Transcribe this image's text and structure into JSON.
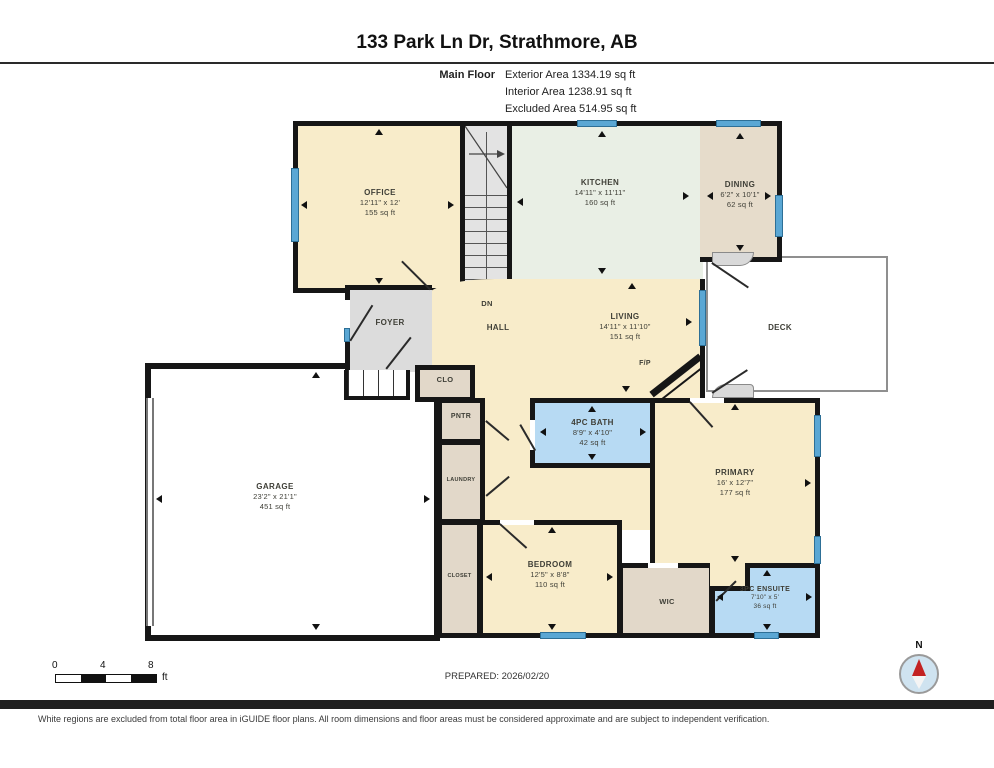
{
  "header": {
    "title": "133 Park Ln Dr, Strathmore, AB",
    "floor_label": "Main Floor",
    "area_lines": [
      "Exterior Area 1334.19 sq ft",
      "Interior Area 1238.91 sq ft",
      "Excluded Area 514.95 sq ft"
    ]
  },
  "rooms": {
    "office": {
      "name": "OFFICE",
      "dims": "12'11\" x 12'",
      "area": "155 sq ft"
    },
    "kitchen": {
      "name": "KITCHEN",
      "dims": "14'11\" x 11'11\"",
      "area": "160 sq ft"
    },
    "dining": {
      "name": "DINING",
      "dims": "6'2\" x 10'1\"",
      "area": "62 sq ft"
    },
    "living": {
      "name": "LIVING",
      "dims": "14'11\" x 11'10\"",
      "area": "151 sq ft"
    },
    "garage": {
      "name": "GARAGE",
      "dims": "23'2\" x 21'1\"",
      "area": "451 sq ft"
    },
    "bath": {
      "name": "4PC BATH",
      "dims": "8'9\" x 4'10\"",
      "area": "42 sq ft"
    },
    "primary": {
      "name": "PRIMARY",
      "dims": "16' x 12'7\"",
      "area": "177 sq ft"
    },
    "bedroom": {
      "name": "BEDROOM",
      "dims": "12'5\" x 8'8\"",
      "area": "110 sq ft"
    },
    "ensuite": {
      "name": "3PC ENSUITE",
      "dims": "7'10\" x 5'",
      "area": "36 sq ft"
    },
    "foyer": {
      "name": "FOYER"
    },
    "hall": {
      "name": "HALL"
    },
    "dn": {
      "name": "DN"
    },
    "deck": {
      "name": "DECK"
    },
    "fp": {
      "name": "F/P"
    },
    "clo": {
      "name": "CLO"
    },
    "pntr": {
      "name": "PNTR"
    },
    "laundry": {
      "name": "LAUNDRY"
    },
    "closet": {
      "name": "CLOSET"
    },
    "wic": {
      "name": "WIC"
    }
  },
  "footer": {
    "scale_ticks": [
      "0",
      "4",
      "8"
    ],
    "scale_unit": "ft",
    "prepared": "PREPARED: 2026/02/20",
    "compass_label": "N",
    "disclaimer": "White regions are excluded from total floor area in iGUIDE floor plans. All room dimensions and floor areas must be considered approximate and are subject to independent verification."
  },
  "colors": {
    "wall": "#161616",
    "room_cream": "#f8ecca",
    "kitchen_mint": "#e9efe5",
    "tan": "#e6dccb",
    "foyer_gray": "#dcdcdc",
    "bath_blue": "#b7daf3",
    "window_blue": "#5aa7d4",
    "compass_red": "#c32222"
  }
}
